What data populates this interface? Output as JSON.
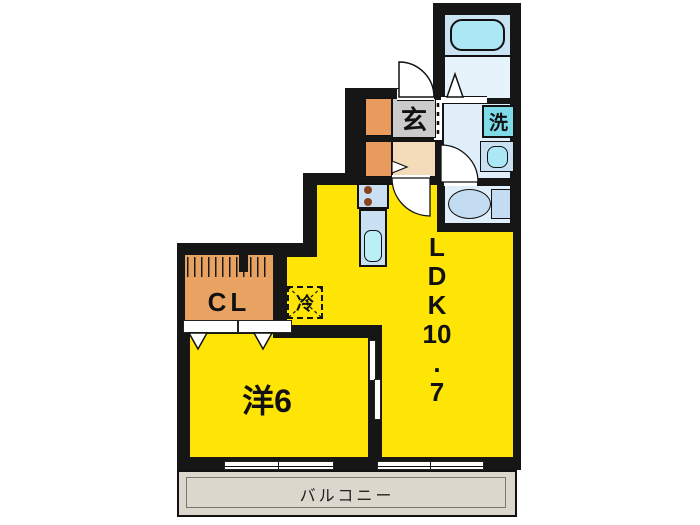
{
  "plan": {
    "title": "1LDK apartment floor plan",
    "rooms": {
      "ldk": {
        "label": "LDK10.7",
        "label_lines": [
          "L",
          "D",
          "K",
          "10",
          ".",
          "7"
        ]
      },
      "western_room": {
        "label": "洋6"
      },
      "entrance": {
        "label": "玄"
      },
      "closet": {
        "label": "CL"
      },
      "washer": {
        "label": "洗"
      },
      "refrigerator": {
        "label": "冷"
      },
      "balcony": {
        "label": "バルコニー"
      }
    },
    "colors": {
      "room_fill": "#FFE506",
      "wall": "#161616",
      "closet_fill": "#E8A261",
      "entrance_tile": "#CBCBCB",
      "hall_floor": "#F4DCBA",
      "wet_area_fill": "#E0EEF9",
      "bathtub": "#ABE7F4",
      "washer_box": "#7FDBE8",
      "kitchen_counter": "#C9DFF2",
      "kitchen_sink": "#B9EFF5",
      "balcony_fill": "#DBD7CD",
      "burner_dot": "#8A4420"
    }
  }
}
